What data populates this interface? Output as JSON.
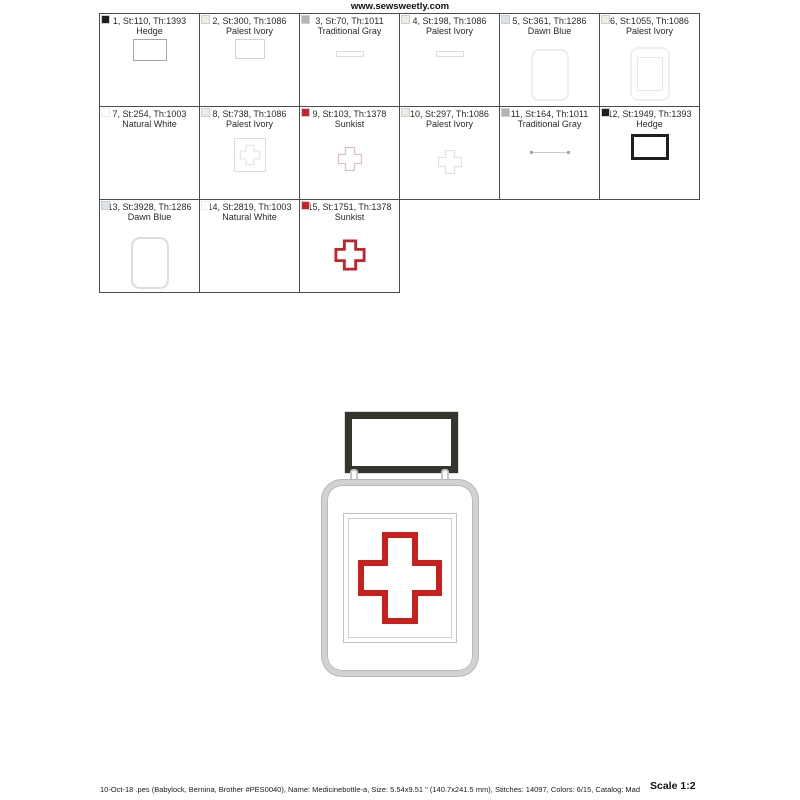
{
  "page": {
    "header": "www.sewsweetly.com",
    "footer": "10-Oct-18  .pes (Babylock, Bernina, Brother #PES0040), Name: Medicinebottle-a, Size: 5.54x9.51 \" (140.7x241.5 mm), Stitches: 14097, Colors: 6/15, Catalog: Mad",
    "scale_label": "Scale 1:2"
  },
  "thread_colors": {
    "hedge": "#1e1e1e",
    "palest_ivory": "#eeebe3",
    "traditional_gray": "#b4b4b4",
    "dawn_blue": "#dbe2e8",
    "natural_white": "#ffffff",
    "sunkist": "#c8252b"
  },
  "design_colors": {
    "cap_dark": "#35352e",
    "body_silver": "#d2d2d2",
    "cross_red": "#c8201f"
  },
  "steps": [
    {
      "label": "1, St:110, Th:1393",
      "name": "Hedge",
      "swatch": "hedge",
      "thumb": "rect-outline-gray"
    },
    {
      "label": "2, St:300, Th:1086",
      "name": "Palest Ivory",
      "swatch": "palest_ivory",
      "thumb": "rect-outline-light"
    },
    {
      "label": "3, St:70, Th:1011",
      "name": "Traditional Gray",
      "swatch": "traditional_gray",
      "thumb": "hline-light"
    },
    {
      "label": "4, St:198, Th:1086",
      "name": "Palest Ivory",
      "swatch": "palest_ivory",
      "thumb": "hline-light"
    },
    {
      "label": "5, St:361, Th:1286",
      "name": "Dawn Blue",
      "swatch": "dawn_blue",
      "thumb": "bottle-body-outline"
    },
    {
      "label": "6, St:1055, Th:1086",
      "name": "Palest Ivory",
      "swatch": "palest_ivory",
      "thumb": "bottle-label-outline"
    },
    {
      "label": "7, St:254, Th:1003",
      "name": "Natural White",
      "swatch": "natural_white",
      "thumb": "none"
    },
    {
      "label": "8, St:738, Th:1086",
      "name": "Palest Ivory",
      "swatch": "palest_ivory",
      "thumb": "label-cross-outline"
    },
    {
      "label": "9, St:103, Th:1378",
      "name": "Sunkist",
      "swatch": "sunkist",
      "thumb": "cross-outline-red-light"
    },
    {
      "label": "10, St:297, Th:1086",
      "name": "Palest Ivory",
      "swatch": "palest_ivory",
      "thumb": "cross-outline-light"
    },
    {
      "label": "11, St:164, Th:1011",
      "name": "Traditional Gray",
      "swatch": "traditional_gray",
      "thumb": "dotted-line"
    },
    {
      "label": "12, St:1949, Th:1393",
      "name": "Hedge",
      "swatch": "hedge",
      "thumb": "rect-outline-bold-black"
    },
    {
      "label": "13, St:3928, Th:1286",
      "name": "Dawn Blue",
      "swatch": "dawn_blue",
      "thumb": "rounded-rect-outline"
    },
    {
      "label": "14, St:2819, Th:1003",
      "name": "Natural White",
      "swatch": "natural_white",
      "thumb": "none"
    },
    {
      "label": "15, St:1751, Th:1378",
      "name": "Sunkist",
      "swatch": "sunkist",
      "thumb": "cross-outline-red-bold"
    }
  ]
}
